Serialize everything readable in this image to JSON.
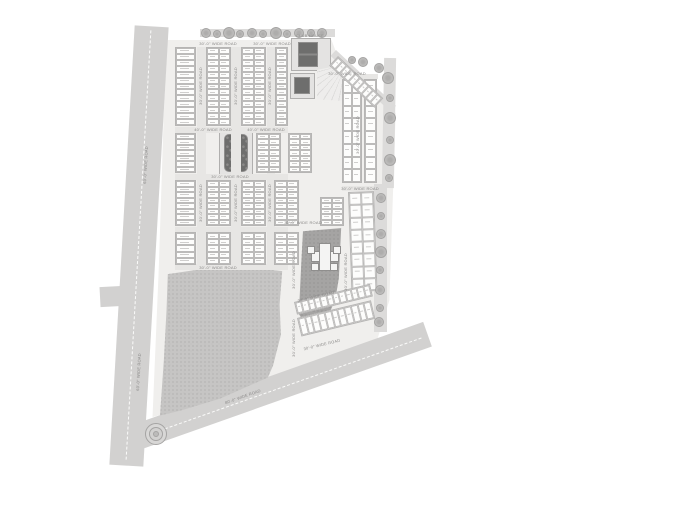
{
  "title": "Township master plan site layout",
  "colors": {
    "background": "#ffffff",
    "main_road": "#d2d1d0",
    "boundary_road": "#dcdbda",
    "site_fill": "#f0efed",
    "park_fill": "#c6c5c4",
    "dark_parcel": "#a5a4a3",
    "dark_building": "#6e6e6d",
    "plot_fill": "#fdfdfc",
    "plot_border": "#bcbbba",
    "label_text": "#8a8988"
  },
  "road_labels": {
    "left_road": "60'-0\" WIDE ROAD",
    "bottom_road": "80'-0\" WIDE ROAD",
    "internal_road": "30'-0\" WIDE ROAD",
    "cross_road": "40'-0\" WIDE ROAD"
  },
  "amenity_labels": {
    "clubhouse": "CLUB HOUSE"
  },
  "labels": [
    {
      "t": "30'-0\" WIDE ROAD",
      "x": 218,
      "y": 44,
      "r": 0
    },
    {
      "t": "30'-0\" WIDE ROAD",
      "x": 272,
      "y": 44,
      "r": 0
    },
    {
      "t": "30'-0\" WIDE ROAD",
      "x": 347,
      "y": 74,
      "r": 0
    },
    {
      "t": "40'-0\" WIDE ROAD",
      "x": 213,
      "y": 130,
      "r": 0
    },
    {
      "t": "40'-0\" WIDE ROAD",
      "x": 266,
      "y": 130,
      "r": 0
    },
    {
      "t": "30'-0\" WIDE ROAD",
      "x": 230,
      "y": 177,
      "r": 0
    },
    {
      "t": "30'-0\" WIDE ROAD",
      "x": 303,
      "y": 223,
      "r": 0
    },
    {
      "t": "30'-0\" WIDE ROAD",
      "x": 218,
      "y": 268,
      "r": 0
    },
    {
      "t": "30'-0\" WIDE ROAD",
      "x": 360,
      "y": 189,
      "r": 0
    },
    {
      "t": "30'-0\" WIDE ROAD",
      "x": 201,
      "y": 86,
      "r": -90
    },
    {
      "t": "30'-0\" WIDE ROAD",
      "x": 236,
      "y": 86,
      "r": -90
    },
    {
      "t": "30'-0\" WIDE ROAD",
      "x": 270,
      "y": 86,
      "r": -90
    },
    {
      "t": "30'-0\" WIDE ROAD",
      "x": 201,
      "y": 203,
      "r": -90
    },
    {
      "t": "30'-0\" WIDE ROAD",
      "x": 236,
      "y": 203,
      "r": -90
    },
    {
      "t": "30'-0\" WIDE ROAD",
      "x": 270,
      "y": 203,
      "r": -90
    },
    {
      "t": "30'-0\" WIDE ROAD",
      "x": 294,
      "y": 270,
      "r": -90
    },
    {
      "t": "30'-0\" WIDE ROAD",
      "x": 294,
      "y": 338,
      "r": -90
    },
    {
      "t": "30'-0\" WIDE ROAD",
      "x": 346,
      "y": 272,
      "r": -90
    },
    {
      "t": "30'-0\" WIDE ROAD",
      "x": 358,
      "y": 135,
      "r": -90
    },
    {
      "t": "30'-0\" WIDE ROAD",
      "x": 316,
      "y": 297,
      "r": -13.5
    },
    {
      "t": "30'-0\" WIDE ROAD",
      "x": 322,
      "y": 345,
      "r": -13.5
    },
    {
      "t": "60'-0\" WIDE ROAD",
      "x": 139,
      "y": 372,
      "r": -87
    },
    {
      "t": "60'-0\" WIDE ROAD",
      "x": 146,
      "y": 165,
      "r": -87
    },
    {
      "t": "80'-0\" WIDE ROAD",
      "x": 243,
      "y": 397,
      "r": -19.5
    },
    {
      "t": "CLUB HOUSE",
      "x": 310,
      "y": 36,
      "r": 0
    }
  ],
  "plot_blocks": [
    [
      175,
      47,
      21,
      79,
      1,
      13,
      0
    ],
    [
      206,
      47,
      25,
      79,
      2,
      13,
      0
    ],
    [
      241,
      47,
      25,
      79,
      2,
      13,
      0
    ],
    [
      275,
      47,
      13,
      79,
      1,
      13,
      0
    ],
    [
      175,
      133,
      21,
      40,
      1,
      7,
      0
    ],
    [
      256,
      133,
      25,
      40,
      2,
      7,
      0
    ],
    [
      288,
      133,
      24,
      40,
      2,
      7,
      0
    ],
    [
      175,
      180,
      21,
      46,
      1,
      8,
      0
    ],
    [
      206,
      180,
      25,
      46,
      2,
      8,
      0
    ],
    [
      241,
      180,
      25,
      46,
      2,
      8,
      0
    ],
    [
      274,
      180,
      25,
      46,
      2,
      8,
      0
    ],
    [
      175,
      232,
      21,
      33,
      1,
      5,
      0
    ],
    [
      206,
      232,
      25,
      33,
      2,
      5,
      0
    ],
    [
      241,
      232,
      25,
      33,
      2,
      5,
      0
    ],
    [
      274,
      232,
      25,
      33,
      2,
      5,
      0
    ],
    [
      342,
      79,
      20,
      104,
      2,
      8,
      0
    ],
    [
      364,
      79,
      13,
      104,
      1,
      8,
      0
    ],
    [
      320,
      197,
      24,
      29,
      2,
      5,
      0
    ],
    [
      348,
      192,
      26,
      100,
      2,
      8,
      -2
    ],
    [
      338,
      56,
      62,
      13,
      10,
      1,
      43
    ],
    [
      294,
      302,
      78,
      13,
      12,
      1,
      -13.5
    ],
    [
      297,
      318,
      76,
      19,
      11,
      1,
      -13.5
    ]
  ],
  "internal_roads": [
    [
      197,
      47,
      9,
      219
    ],
    [
      231,
      47,
      10,
      219
    ],
    [
      267,
      47,
      8,
      219
    ],
    [
      175,
      127,
      113,
      6
    ],
    [
      175,
      174,
      113,
      6
    ],
    [
      175,
      227,
      113,
      5
    ],
    [
      175,
      264,
      113,
      6
    ],
    [
      340,
      74,
      38,
      5
    ],
    [
      342,
      186,
      32,
      5
    ]
  ],
  "trees": [
    [
      206,
      33,
      5
    ],
    [
      217,
      34,
      4
    ],
    [
      229,
      33,
      6
    ],
    [
      240,
      34,
      4
    ],
    [
      252,
      33,
      5
    ],
    [
      263,
      34,
      4
    ],
    [
      276,
      33,
      6
    ],
    [
      287,
      34,
      4
    ],
    [
      299,
      33,
      5
    ],
    [
      311,
      33,
      4
    ],
    [
      322,
      33,
      5
    ],
    [
      352,
      60,
      4
    ],
    [
      363,
      62,
      5
    ],
    [
      379,
      68,
      5
    ],
    [
      388,
      78,
      6
    ],
    [
      390,
      98,
      4
    ],
    [
      390,
      118,
      6
    ],
    [
      390,
      140,
      4
    ],
    [
      390,
      160,
      6
    ],
    [
      389,
      178,
      4
    ],
    [
      381,
      198,
      5
    ],
    [
      381,
      216,
      4
    ],
    [
      381,
      234,
      5
    ],
    [
      381,
      252,
      6
    ],
    [
      380,
      270,
      4
    ],
    [
      380,
      290,
      5
    ],
    [
      380,
      308,
      4
    ],
    [
      379,
      322,
      5
    ]
  ]
}
